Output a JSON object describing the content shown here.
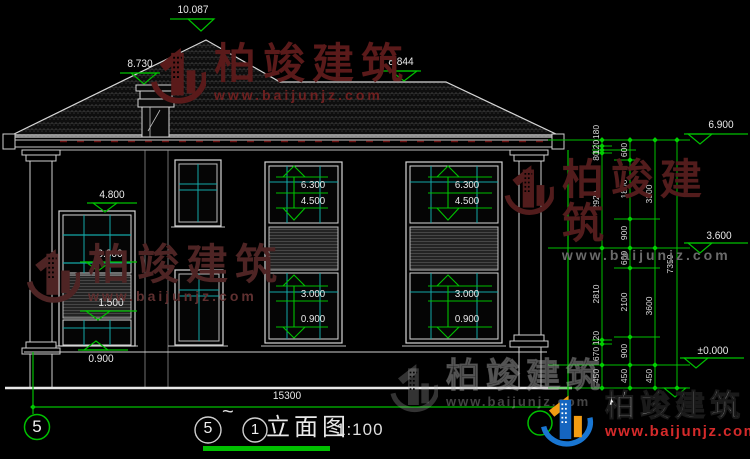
{
  "watermark": {
    "brand": "柏竣建筑",
    "url": "www.baijunjz.com"
  },
  "levels": {
    "ridge": "10.087",
    "chimney_top": "8.730",
    "sub_ridge": "8.844",
    "eave": "6.900",
    "second_floor": "3.600",
    "ground": "±0.000",
    "bay_top": "4.800",
    "bay_mid": "3.000",
    "bay_low": "1.500",
    "first_sill": "0.900"
  },
  "window_marks": {
    "up_top": "6.300",
    "up_sill": "4.500",
    "low_top": "3.000",
    "low_sill": "0.900"
  },
  "chains": {
    "inner": [
      "180",
      "120",
      "80",
      "2920",
      "2810",
      "120",
      "670",
      "450"
    ],
    "detail": [
      "600",
      "1800",
      "900",
      "600",
      "2100",
      "900",
      "450"
    ],
    "floors": [
      "3300",
      "3600",
      "450"
    ],
    "total": "7350",
    "width": "15300"
  },
  "title": {
    "axis_left": "5",
    "from": "5",
    "tilde": "~",
    "to": "1",
    "name": "立面图",
    "scale": "1:100"
  }
}
